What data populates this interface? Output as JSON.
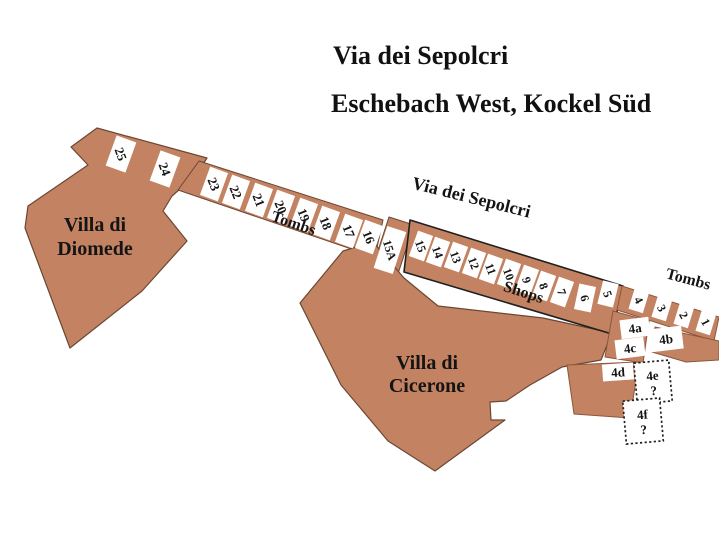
{
  "header": {
    "title": "Via dei Sepolcri",
    "subtitle": "Eschebach West, Kockel Süd"
  },
  "map": {
    "palette": {
      "land_fill": "#C38362",
      "outline_dark": "#6b4733",
      "outline_black": "#1f1f1f",
      "outline_mid": "#8a573c",
      "box_fill": "#ffffff",
      "text_color": "#141414"
    },
    "regions": [
      {
        "name": "villa-di-diomede-area",
        "points": "97,128 207,158 196,175 172,196 163,211 187,241 142,291 70,348 25,228 28,206 88,165 71,147",
        "stroke": "dark",
        "stroke_width": 1.2
      },
      {
        "name": "tombs-strip-west",
        "points": "199,161 383,220 375,257 178,190",
        "stroke": "dark",
        "stroke_width": 1
      },
      {
        "name": "block-15a",
        "points": "389,217 414,225 393,289 368,281",
        "stroke": "dark",
        "stroke_width": 1
      },
      {
        "name": "villa-di-cicerone-area",
        "points": "300,303 343,251 373,242 404,278 438,306 543,318 612,333 601,360 562,367 530,385 506,401 490,402 491,420 505,420 435,471 388,441 341,385",
        "stroke": "dark",
        "stroke_width": 1.2
      },
      {
        "name": "shops-strip",
        "points": "410,220 623,286 612,334 404,272",
        "stroke": "black",
        "stroke_width": 1.6
      },
      {
        "name": "tombs-strip-east",
        "points": "622,286 719,317 714,341 617,310",
        "stroke": "mid",
        "stroke_width": 1
      },
      {
        "name": "block-under-1-and-4b",
        "points": "655,327 719,341 719,360 686,362 652,352",
        "stroke": "mid",
        "stroke_width": 1
      },
      {
        "name": "block-4a-4c",
        "points": "613,311 649,321 643,363 605,357",
        "stroke": "mid",
        "stroke_width": 1
      },
      {
        "name": "block-4d",
        "points": "567,365 639,362 630,418 574,414",
        "stroke": "mid",
        "stroke_width": 1
      }
    ],
    "boxes": [
      {
        "label": "25",
        "cx": 121,
        "cy": 154,
        "w": 21,
        "h": 32,
        "box_rot": 20,
        "text_rot": 70,
        "font_size": 13
      },
      {
        "label": "24",
        "cx": 165,
        "cy": 169,
        "w": 21,
        "h": 32,
        "box_rot": 20,
        "text_rot": 70,
        "font_size": 13
      },
      {
        "label": "23",
        "cx": 214,
        "cy": 184,
        "w": 19,
        "h": 30,
        "box_rot": 20,
        "text_rot": 68,
        "font_size": 13
      },
      {
        "label": "22",
        "cx": 236,
        "cy": 192,
        "w": 19,
        "h": 30,
        "box_rot": 20,
        "text_rot": 68,
        "font_size": 13
      },
      {
        "label": "21",
        "cx": 259,
        "cy": 200,
        "w": 19,
        "h": 30,
        "box_rot": 20,
        "text_rot": 68,
        "font_size": 13
      },
      {
        "label": "20",
        "cx": 281,
        "cy": 207,
        "w": 19,
        "h": 30,
        "box_rot": 20,
        "text_rot": 68,
        "font_size": 13
      },
      {
        "label": "19",
        "cx": 304,
        "cy": 215,
        "w": 19,
        "h": 30,
        "box_rot": 20,
        "text_rot": 68,
        "font_size": 13
      },
      {
        "label": "18",
        "cx": 326,
        "cy": 223,
        "w": 19,
        "h": 30,
        "box_rot": 20,
        "text_rot": 68,
        "font_size": 13
      },
      {
        "label": "17",
        "cx": 349,
        "cy": 231,
        "w": 19,
        "h": 30,
        "box_rot": 20,
        "text_rot": 68,
        "font_size": 13
      },
      {
        "label": "16",
        "cx": 369,
        "cy": 237,
        "w": 19,
        "h": 30,
        "box_rot": 20,
        "text_rot": 68,
        "font_size": 13
      },
      {
        "label": "15A",
        "cx": 390,
        "cy": 250,
        "w": 20,
        "h": 44,
        "box_rot": 18,
        "text_rot": 72,
        "font_size": 12
      },
      {
        "label": "15",
        "cx": 421,
        "cy": 246,
        "w": 16,
        "h": 27,
        "box_rot": 20,
        "text_rot": 70,
        "font_size": 12
      },
      {
        "label": "14",
        "cx": 438,
        "cy": 252,
        "w": 16,
        "h": 27,
        "box_rot": 20,
        "text_rot": 70,
        "font_size": 12
      },
      {
        "label": "13",
        "cx": 456,
        "cy": 257,
        "w": 16,
        "h": 27,
        "box_rot": 20,
        "text_rot": 70,
        "font_size": 12
      },
      {
        "label": "12",
        "cx": 474,
        "cy": 263,
        "w": 16,
        "h": 27,
        "box_rot": 20,
        "text_rot": 70,
        "font_size": 12
      },
      {
        "label": "11",
        "cx": 491,
        "cy": 269,
        "w": 16,
        "h": 27,
        "box_rot": 20,
        "text_rot": 70,
        "font_size": 12
      },
      {
        "label": "10",
        "cx": 509,
        "cy": 274,
        "w": 16,
        "h": 27,
        "box_rot": 20,
        "text_rot": 70,
        "font_size": 12
      },
      {
        "label": "9",
        "cx": 527,
        "cy": 280,
        "w": 16,
        "h": 27,
        "box_rot": 20,
        "text_rot": 70,
        "font_size": 12
      },
      {
        "label": "8",
        "cx": 544,
        "cy": 286,
        "w": 16,
        "h": 27,
        "box_rot": 20,
        "text_rot": 70,
        "font_size": 12
      },
      {
        "label": "7",
        "cx": 562,
        "cy": 292,
        "w": 16,
        "h": 27,
        "box_rot": 20,
        "text_rot": 70,
        "font_size": 12
      },
      {
        "label": "6",
        "cx": 585,
        "cy": 298,
        "w": 17,
        "h": 26,
        "box_rot": 12,
        "text_rot": 73,
        "font_size": 12
      },
      {
        "label": "5",
        "cx": 608,
        "cy": 294,
        "w": 16,
        "h": 24,
        "box_rot": 14,
        "text_rot": 70,
        "font_size": 12
      },
      {
        "label": "4",
        "cx": 639,
        "cy": 300,
        "w": 15,
        "h": 23,
        "box_rot": 17,
        "text_rot": 62,
        "font_size": 12
      },
      {
        "label": "3",
        "cx": 662,
        "cy": 308,
        "w": 15,
        "h": 23,
        "box_rot": 17,
        "text_rot": 62,
        "font_size": 12
      },
      {
        "label": "2",
        "cx": 684,
        "cy": 315,
        "w": 15,
        "h": 23,
        "box_rot": 17,
        "text_rot": 62,
        "font_size": 12
      },
      {
        "label": "1",
        "cx": 706,
        "cy": 322,
        "w": 15,
        "h": 23,
        "box_rot": 17,
        "text_rot": 62,
        "font_size": 12
      },
      {
        "label": "4a",
        "cx": 635,
        "cy": 328,
        "w": 29,
        "h": 19,
        "box_rot": -7,
        "text_rot": -7,
        "font_size": 13
      },
      {
        "label": "4b",
        "cx": 666,
        "cy": 339,
        "w": 33,
        "h": 23,
        "box_rot": -7,
        "text_rot": -7,
        "font_size": 13
      },
      {
        "label": "4c",
        "cx": 630,
        "cy": 348,
        "w": 29,
        "h": 19,
        "box_rot": -7,
        "text_rot": -7,
        "font_size": 13
      },
      {
        "label": "4d",
        "cx": 618,
        "cy": 372,
        "w": 31,
        "h": 17,
        "box_rot": -4,
        "text_rot": -4,
        "font_size": 13
      },
      {
        "label": "4e",
        "question": "?",
        "cx": 653,
        "cy": 382,
        "w": 35,
        "h": 41,
        "box_rot": -5,
        "text_rot": -5,
        "font_size": 13,
        "dashed": true
      },
      {
        "label": "4f",
        "question": "?",
        "cx": 643,
        "cy": 421,
        "w": 37,
        "h": 43,
        "box_rot": -5,
        "text_rot": -5,
        "font_size": 13,
        "dashed": true
      }
    ],
    "labels": [
      {
        "name": "villa-diomede-label",
        "lines": [
          "Villa di",
          "Diomede"
        ],
        "x": 95,
        "y": 231,
        "line_height": 24,
        "font_size": 20,
        "rot": 0
      },
      {
        "name": "villa-cicerone-label",
        "lines": [
          "Villa di",
          "Cicerone"
        ],
        "x": 427,
        "y": 369,
        "line_height": 23,
        "font_size": 20,
        "rot": 0
      },
      {
        "name": "tombs-west-label",
        "lines": [
          "Tombs"
        ],
        "x": 292,
        "y": 228,
        "line_height": 0,
        "font_size": 16,
        "rot": 19
      },
      {
        "name": "shops-label",
        "lines": [
          "Shops"
        ],
        "x": 522,
        "y": 297,
        "line_height": 0,
        "font_size": 16,
        "rot": 18
      },
      {
        "name": "street-label",
        "lines": [
          "Via dei Sepolcri"
        ],
        "x": 470,
        "y": 203,
        "line_height": 0,
        "font_size": 18,
        "rot": 14
      },
      {
        "name": "tombs-east-label",
        "lines": [
          "Tombs"
        ],
        "x": 687,
        "y": 284,
        "line_height": 0,
        "font_size": 16,
        "rot": 15
      }
    ]
  }
}
